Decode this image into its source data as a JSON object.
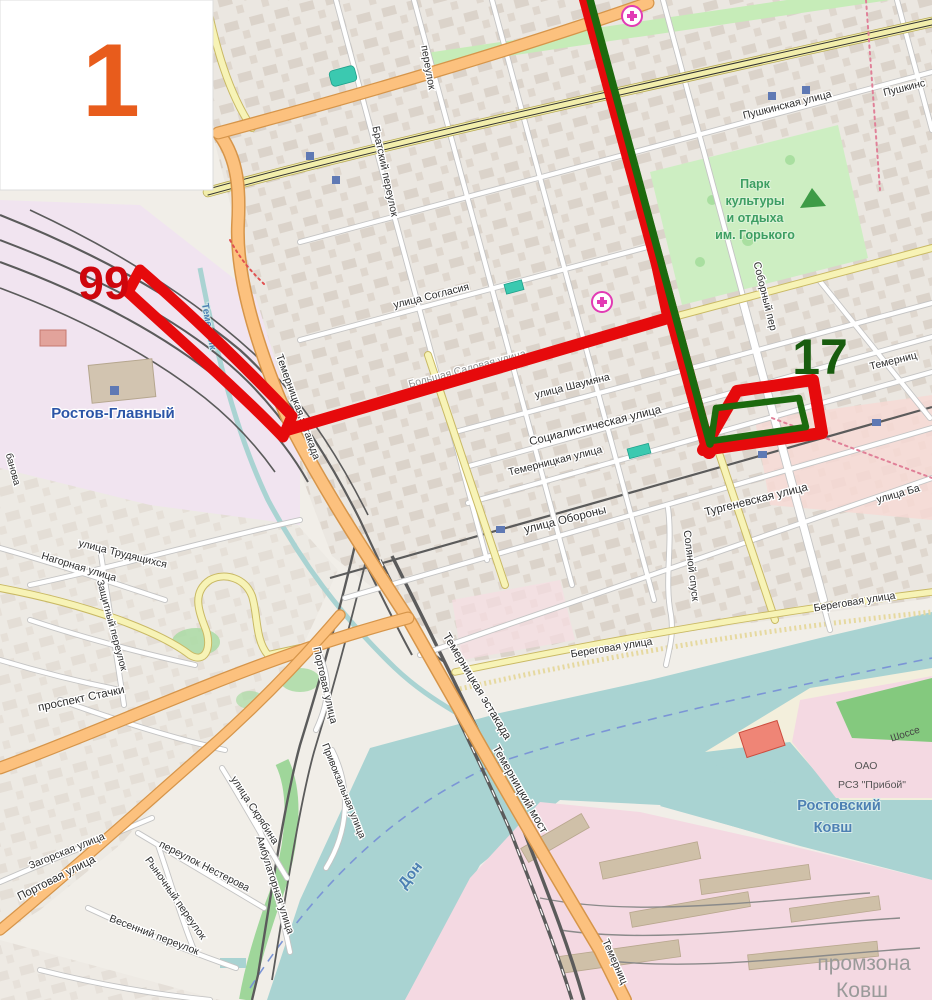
{
  "map": {
    "legend_number": "1",
    "route_badges": {
      "bus_99": "99",
      "bus_17": "17"
    },
    "colors": {
      "route_red": "#e60a0c",
      "route_green": "#1c6a0e",
      "badge_orange": "#e85c1c",
      "water": "#a9d3d2",
      "park": "#cdeec2",
      "road_orange": "#fcc17e",
      "road_yellow": "#f7f3b6",
      "railway": "#5b5b5b",
      "label_text": "#2e2e2e",
      "water_text": "#4d80b3",
      "station_text": "#2b55a7",
      "promzona_text": "#9a9a9a"
    },
    "streets": {
      "pushkinskaya": "Пушкинская улица",
      "pushkinskaya_partial": "Пушкинс",
      "soglasiya": "улица Согласия",
      "bolshaya_sadovaya": "Большая Садовая улица",
      "shaumyana": "улица Шаумяна",
      "sotsialisticheskaya": "Социалистическая улица",
      "temernitskaya": "Темерницкая улица",
      "temernitskaya_right": "Темерниц",
      "oborony": "улица Обороны",
      "turgenevskaya": "Тургеневская улица",
      "sobornyj": "Соборный пер",
      "solyanoj": "Соляной спуск",
      "ulitsa_ba": "улица Ба",
      "beregovaya_right": "Береговая улица",
      "beregovaya_center": "Береговая улица",
      "bratskij": "Братский переулок",
      "pereulok_partial": "переулок",
      "estakada_upper": "Темерницкая эстакада",
      "estakada_main": "Темерницкая эстакада",
      "most": "Темерницкий мост",
      "temernits_bottom": "Темерниц",
      "stachki": "проспект Стачки",
      "trudyashchikhsya": "улица Трудящихся",
      "nagornaya": "Нагорная улица",
      "zashchitnyj": "Защитный переулок",
      "zagorskaya": "Загорская улица",
      "nesterova": "переулок Нестерова",
      "rynochnyj": "Рыночный переулок",
      "vesennij": "Весенний переулок",
      "skryabina": "улица Скрябина",
      "ambulatornaya": "Амбулаторная улица",
      "portovaya_orange": "Портовая улица",
      "portovaya_vertical": "Портовая улица",
      "privokzalnaya": "Привокзальная улица",
      "banova_partial": "банова"
    },
    "places": {
      "station": "Ростов-Главный",
      "park_lines": [
        "Парк",
        "культуры",
        "и отдыха",
        "им. Горького"
      ],
      "don_river": "Дон",
      "temernik_river": "Темерник",
      "kovsh_lines": [
        "Ростовский",
        "Ковш"
      ],
      "promzona_lines": [
        "промзона",
        "Ковш"
      ],
      "oao_lines": [
        "ОАО",
        "РСЗ \"Прибой\""
      ],
      "shosse": "Шоссе"
    }
  }
}
